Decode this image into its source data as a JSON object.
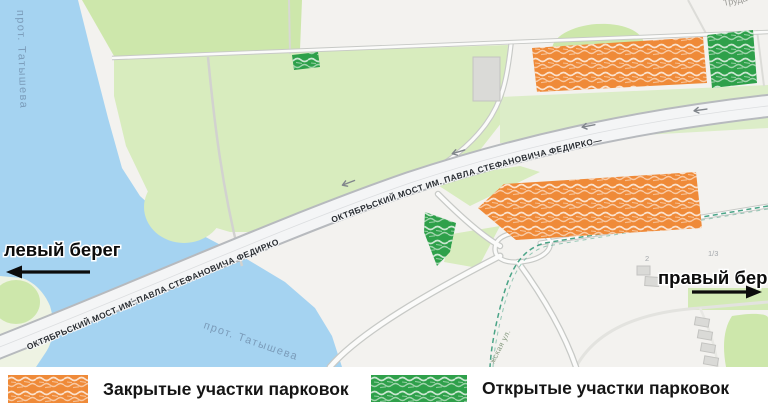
{
  "map": {
    "river_label_vertical": "прот. Татышева",
    "river_label_diagonal": "прот. Татышева",
    "bridge_label_sw": "ОКТЯБРЬСКИЙ МОСТ ИМ. ПАВЛА СТЕФАНОВИЧА ФЕДИРКО",
    "bridge_label_mid": "ОКТЯБРЬСКИЙ МОСТ ИМ. ПАВЛА СТЕФАНОВИЧА ФЕДИРКО—",
    "left_bank_label": "левый берег",
    "right_bank_label": "правый берег",
    "street_truda": "Труда",
    "street_small": "жская ул.",
    "house_number_2": "2",
    "house_number_13": "1/3"
  },
  "legend": {
    "items": [
      {
        "id": "closed",
        "label": "Закрытые участки парковок",
        "color": "#ef8a38"
      },
      {
        "id": "open",
        "label": "Открытые участки парковок",
        "color": "#2ea04a"
      }
    ]
  },
  "colors": {
    "water": "#a5d3f1",
    "land": "#f3f2ef",
    "park": "#d8ecbe",
    "closed_parking": "#ef8a38",
    "open_parking": "#2ea04a",
    "road_casing": "#c7c9c6",
    "road_fill": "#fbfbfa",
    "bridge_casing": "#b7babe",
    "bridge_fill": "#f4f5f6",
    "dashed_path": "#4aa487",
    "water_text": "#7b9cba"
  }
}
